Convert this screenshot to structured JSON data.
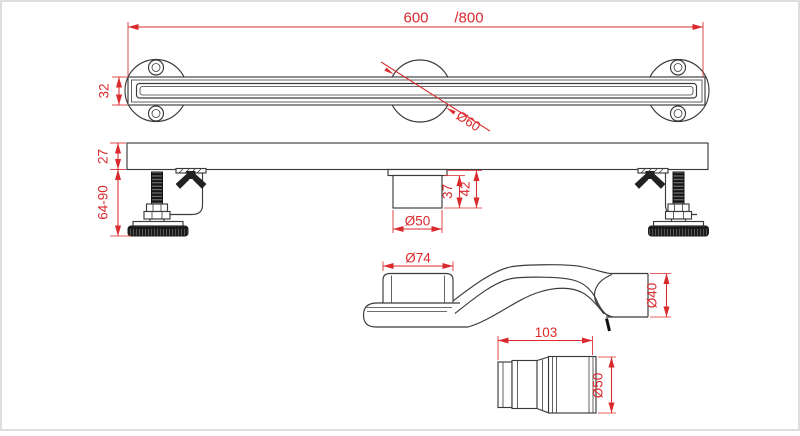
{
  "drawing": {
    "type": "linear-shower-drain-technical-drawing",
    "top_view": {
      "length": "600",
      "length_alt": "/800",
      "height": "32",
      "center_dia": "Ø60"
    },
    "side_view": {
      "body_height": "27",
      "feet_range": "64-90",
      "outlet_depth": "37",
      "outlet_height": "42",
      "outlet_dia": "Ø50"
    },
    "trap_view": {
      "inlet_dia": "Ø74",
      "pipe_dia": "Ø40"
    },
    "connector_view": {
      "length": "103",
      "pipe_dia": "Ø50"
    },
    "colors": {
      "dimension_red": "#da2a2e",
      "line_dark": "#3b3b3b",
      "fill_black": "#1b1b1b",
      "frame_gray": "#d4d4d4"
    }
  }
}
